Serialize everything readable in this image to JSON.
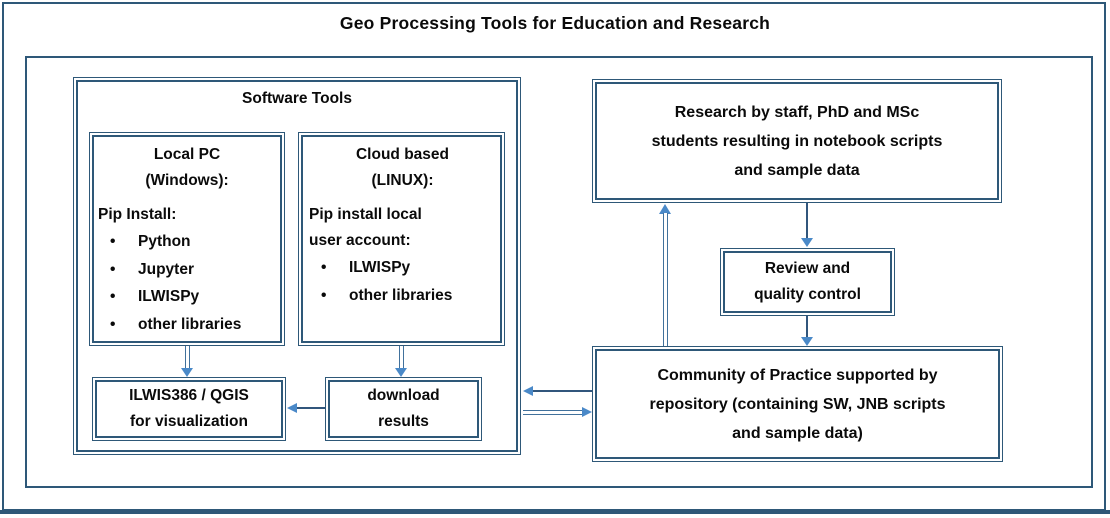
{
  "title": "Geo Processing Tools for Education and Research",
  "software_tools": {
    "heading": "Software Tools",
    "local_pc": {
      "title_lines": [
        "Local PC",
        "(Windows):"
      ],
      "subheading": "Pip Install:",
      "items": [
        "Python",
        "Jupyter",
        "ILWISPy",
        "other libraries"
      ]
    },
    "cloud": {
      "title_lines": [
        "Cloud based",
        "(LINUX):"
      ],
      "subheading_lines": [
        "Pip install local",
        "user account:"
      ],
      "items": [
        "ILWISPy",
        "other libraries"
      ]
    },
    "visualization": {
      "lines": [
        "ILWIS386 / QGIS",
        "for visualization"
      ]
    },
    "download": {
      "lines": [
        "download",
        "results"
      ]
    }
  },
  "right_flow": {
    "research": {
      "lines": [
        "Research by staff, PhD and MSc",
        "students resulting in notebook scripts",
        "and sample data"
      ]
    },
    "review": {
      "lines": [
        "Review and",
        "quality control"
      ]
    },
    "community": {
      "lines": [
        "Community of Practice supported by",
        "repository (containing SW, JNB scripts",
        "and sample data)"
      ]
    }
  },
  "colors": {
    "box_border": "#2e5878",
    "arrow_shaft": "#41719c",
    "arrow_head": "#4a89c8",
    "text": "#0a0a0a"
  }
}
